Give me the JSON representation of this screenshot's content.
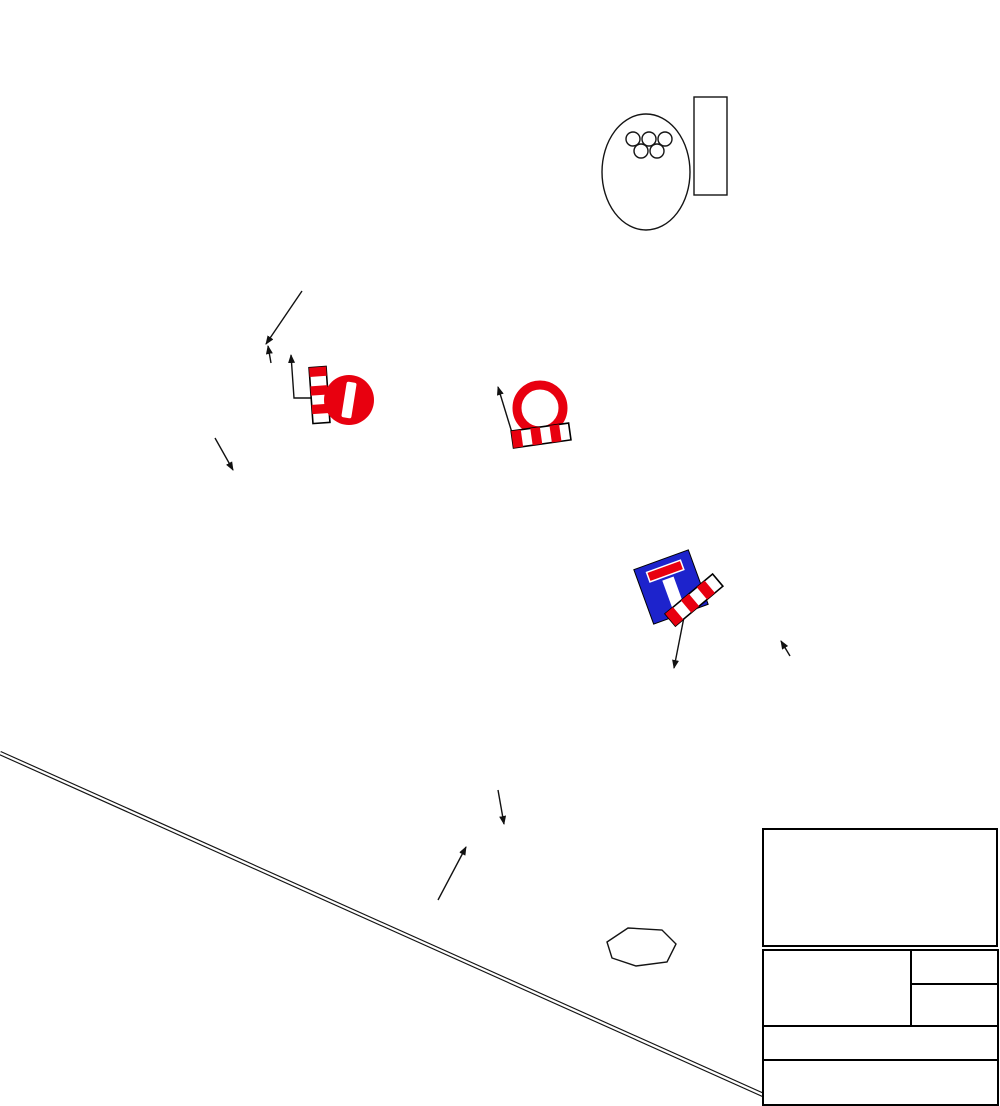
{
  "legend": {
    "title": "LEGENDA:",
    "items": [
      {
        "label": "miejsce wykonywania robót",
        "color": "#9C9C9C"
      },
      {
        "label": "objazd",
        "color": "#74ADE0"
      }
    ]
  },
  "title_block": {
    "contractor_label": "Wykonawca:",
    "contractor_lines": [
      "Rejon Budowy Dróg i Mostów",
      "sp. z. o. o.",
      "Tysiąclecia 38",
      "+48 13 432 34 61",
      "sekretariat@rbdim.pl"
    ],
    "investor_label": "Inwestor:",
    "location_label": "lokalizacja",
    "location_value": "ulica: Powst",
    "task_label": "Zadanie:",
    "task_value": "„Odcinkowa wymiana nawierzchni bitumicz",
    "drawing_label": "Rysunek:",
    "drawing_value": "OBJAZD"
  },
  "map": {
    "colors": {
      "detour": "#74ADE0",
      "roadworks": "#9C9C9C",
      "sign_yellow": "#FFE400",
      "sign_red": "#E8000F",
      "sign_blue": "#1D23CC"
    },
    "street_labels": [
      {
        "text": "ul.KAPUCYŃSKA",
        "x": 57,
        "y": 77,
        "rot": 40,
        "size": 15
      },
      {
        "text": "ul.NIEPO",
        "x": 271,
        "y": 30,
        "rot": -83,
        "size": 14
      },
      {
        "text": "ul.BURSAKI",
        "x": 150,
        "y": 183,
        "rot": 44,
        "size": 15
      },
      {
        "text": "ul.BURSAKI",
        "x": 352,
        "y": 121,
        "rot": 30,
        "size": 15
      },
      {
        "text": "ul.BURSAKI",
        "x": 390,
        "y": 184,
        "rot": 14,
        "size": 15
      },
      {
        "text": "ul.BURSAKI",
        "x": 645,
        "y": 229,
        "rot": 17,
        "size": 15
      },
      {
        "text": "MOSIR \"BURSAKI\"",
        "x": 617,
        "y": 103,
        "rot": 0,
        "size": 16
      },
      {
        "text": "ul.SZARYCH SZEREGÓW",
        "x": 675,
        "y": 297,
        "rot": 11,
        "size": 15
      },
      {
        "text": "pl. MONTE CASSINO",
        "x": 137,
        "y": 289,
        "rot": -4,
        "size": 15
      },
      {
        "text": "ul.POWST. WARSZAWSKICH",
        "x": 205,
        "y": 317,
        "rot": 7,
        "size": 15
      },
      {
        "text": "ul.POWST. WARSZAWSKICH",
        "x": 622,
        "y": 387,
        "rot": 15,
        "size": 15
      },
      {
        "text": "ul.LENARTA J.",
        "x": 482,
        "y": 272,
        "rot": -84,
        "size": 14
      },
      {
        "text": "KRZYWA",
        "x": 390,
        "y": 240,
        "rot": -9,
        "size": 13
      },
      {
        "text": "A S",
        "x": 8,
        "y": 206,
        "rot": 50,
        "size": 13
      },
      {
        "text": "RGI P.",
        "x": 22,
        "y": 238,
        "rot": 8,
        "size": 13
      },
      {
        "text": "LEBENA T.",
        "x": 30,
        "y": 364,
        "rot": 10,
        "size": 13
      },
      {
        "text": "ŚCI",
        "x": 12,
        "y": 463,
        "rot": 60,
        "size": 13
      },
      {
        "text": "ul.LWOWSKA",
        "x": 104,
        "y": 481,
        "rot": 82,
        "size": 15
      },
      {
        "text": "ul.WOJSKA POLSKIEGO",
        "x": 196,
        "y": 453,
        "rot": 55,
        "size": 15
      },
      {
        "text": "ul.WOJSKA POLSKIEGO",
        "x": 391,
        "y": 708,
        "rot": 52,
        "size": 15
      },
      {
        "text": "ul.S.BETLEJA",
        "x": 184,
        "y": 592,
        "rot": 84,
        "size": 14
      },
      {
        "text": "ul.OFICERSKA",
        "x": 252,
        "y": 617,
        "rot": -21,
        "size": 14
      },
      {
        "text": "ul.MICKIEWICZA A.",
        "x": 606,
        "y": 597,
        "rot": 65,
        "size": 14
      },
      {
        "text": "ul.POWST. ŚLĄSKICH",
        "x": 795,
        "y": 553,
        "rot": -70,
        "size": 14
      },
      {
        "text": "SKICH",
        "x": 884,
        "y": 803,
        "rot": 80,
        "size": 14
      },
      {
        "text": "ul.RÓŻANA",
        "x": 856,
        "y": 636,
        "rot": -62,
        "size": 14
      },
      {
        "text": "ul.CHOPINA F.",
        "x": 972,
        "y": 641,
        "rot": 70,
        "size": 14
      },
      {
        "text": "ul.BOH. WESTERPLATTE",
        "x": 589,
        "y": 771,
        "rot": -38,
        "size": 15
      },
      {
        "text": "ul.ARMII KRAJOWEJ",
        "x": 612,
        "y": 858,
        "rot": 72,
        "size": 14
      },
      {
        "text": "ul.PODCHORĄŻYCH",
        "x": 352,
        "y": 846,
        "rot": -11,
        "size": 14
      },
      {
        "text": "ul.BOH. WESTERPLATTE",
        "x": 278,
        "y": 917,
        "rot": 57,
        "size": 13
      },
      {
        "text": "ul.LWOWSKA",
        "x": 228,
        "y": 1030,
        "rot": 76,
        "size": 14
      },
      {
        "text": "ul.PIASTOWSKA",
        "x": 62,
        "y": 753,
        "rot": 73,
        "size": 14
      },
      {
        "text": "ul.PIASTOWSKA",
        "x": 103,
        "y": 926,
        "rot": 72,
        "size": 14
      },
      {
        "text": "PODKARPACKA",
        "x": 45,
        "y": 1056,
        "rot": 38,
        "size": 14
      },
      {
        "text": "ul.SIKORSKIEGO W.",
        "x": 574,
        "y": 967,
        "rot": 52,
        "size": 14
      },
      {
        "text": "ul.WI",
        "x": 745,
        "y": 1060,
        "rot": -33,
        "size": 14
      }
    ],
    "annotations": [
      {
        "text": "F-9",
        "x": 406,
        "y": 263,
        "rot": 0,
        "size": 21
      },
      {
        "text": "prj",
        "x": 384,
        "y": 287,
        "rot": 0,
        "size": 21
      },
      {
        "text": "B-2",
        "x": 351,
        "y": 433,
        "rot": 90,
        "size": 13
      },
      {
        "text": "prj",
        "x": 334,
        "y": 430,
        "rot": 90,
        "size": 13
      },
      {
        "text": "U-20b",
        "x": 317,
        "y": 443,
        "rot": 90,
        "size": 13
      },
      {
        "text": "prj",
        "x": 301,
        "y": 431,
        "rot": 90,
        "size": 13
      },
      {
        "text": "B-1",
        "x": 573,
        "y": 402,
        "rot": 0,
        "size": 14
      },
      {
        "text": "prj",
        "x": 571,
        "y": 418,
        "rot": 0,
        "size": 14
      },
      {
        "text": "U-20b",
        "x": 590,
        "y": 430,
        "rot": 0,
        "size": 14
      },
      {
        "text": "prj",
        "x": 582,
        "y": 447,
        "rot": 0,
        "size": 14
      },
      {
        "text": "F-9",
        "x": 131,
        "y": 360,
        "rot": 212,
        "size": 15
      },
      {
        "text": "prj",
        "x": 151,
        "y": 349,
        "rot": 212,
        "size": 14
      },
      {
        "text": "prj",
        "x": 366,
        "y": 467,
        "rot": 90,
        "size": 14
      },
      {
        "text": "F-9",
        "x": 385,
        "y": 473,
        "rot": 38,
        "size": 16
      },
      {
        "text": "F-9",
        "x": 420,
        "y": 481,
        "rot": -33,
        "size": 16
      },
      {
        "text": "prj",
        "x": 428,
        "y": 501,
        "rot": -33,
        "size": 14
      },
      {
        "text": "F-9",
        "x": 687,
        "y": 497,
        "rot": -38,
        "size": 16
      },
      {
        "text": "prj",
        "x": 699,
        "y": 517,
        "rot": -38,
        "size": 14
      },
      {
        "text": "D-4a",
        "x": 690,
        "y": 546,
        "rot": 56,
        "size": 13
      },
      {
        "text": "prj",
        "x": 695,
        "y": 566,
        "rot": 56,
        "size": 13
      },
      {
        "text": "U-20b",
        "x": 728,
        "y": 571,
        "rot": -28,
        "size": 14
      },
      {
        "text": "prj",
        "x": 736,
        "y": 591,
        "rot": -28,
        "size": 13
      },
      {
        "text": "F-9",
        "x": 853,
        "y": 737,
        "rot": -52,
        "size": 17
      },
      {
        "text": "prj",
        "x": 835,
        "y": 749,
        "rot": -52,
        "size": 17
      },
      {
        "text": "F-9",
        "x": 424,
        "y": 700,
        "rot": 212,
        "size": 15
      },
      {
        "text": "prj",
        "x": 443,
        "y": 689,
        "rot": 212,
        "size": 14
      },
      {
        "text": "F-9",
        "x": 409,
        "y": 971,
        "rot": 212,
        "size": 15
      },
      {
        "text": "prj",
        "x": 414,
        "y": 950,
        "rot": 212,
        "size": 14
      }
    ],
    "detour_signs": [
      {
        "type": "objazd",
        "label": "Objazd",
        "x": 180,
        "y": 400,
        "rot": 42,
        "flip": true,
        "arrow": "end"
      },
      {
        "type": "objazd",
        "label": "Objazd",
        "x": 382,
        "y": 407,
        "rot": 97,
        "flip": false,
        "arrow": "end"
      },
      {
        "type": "objazd",
        "label": "Objazd",
        "x": 374,
        "y": 528,
        "rot": -26,
        "flip": false,
        "arrow": "end"
      },
      {
        "type": "objazd",
        "label": "Objazd",
        "x": 648,
        "y": 545,
        "rot": -42,
        "flip": false,
        "arrow": "start"
      },
      {
        "type": "objazd",
        "label": "Objazd",
        "x": 466,
        "y": 743,
        "rot": 52,
        "flip": true,
        "arrow": "start"
      },
      {
        "type": "objazd",
        "label": "Objazd",
        "x": 464,
        "y": 927,
        "rot": -40,
        "flip": true,
        "arrow": "end"
      },
      {
        "type": "koniec",
        "label": "Koniec objazdu",
        "x": 336,
        "y": 272,
        "rot": 0,
        "flip": false,
        "arrow": null
      },
      {
        "type": "koniec",
        "label": "Koniec objazdu",
        "x": 812,
        "y": 694,
        "rot": 50,
        "flip": false,
        "arrow": null
      }
    ]
  }
}
